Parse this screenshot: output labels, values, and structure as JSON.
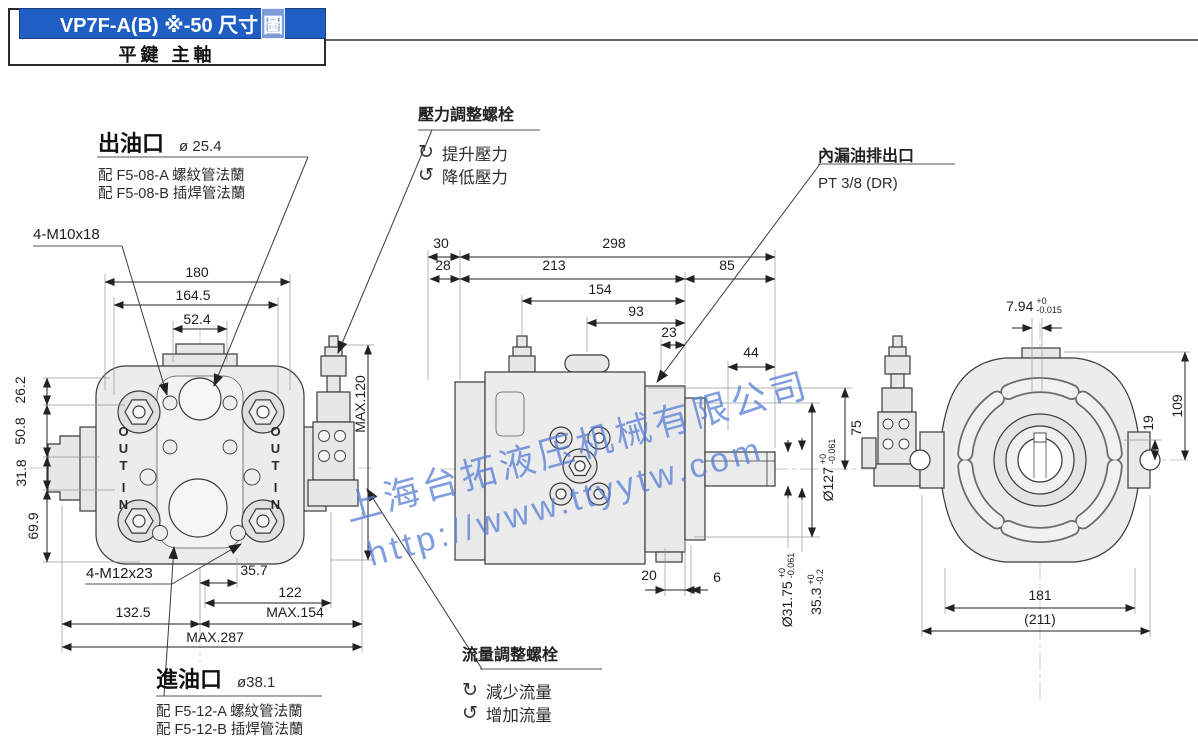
{
  "header": {
    "title_main": "VP7F-A(B) ※-50 尺寸",
    "title_tail": "圖",
    "subtitle": "平鍵 主軸"
  },
  "callouts": {
    "outlet": {
      "title": "出油口",
      "dia": "ø 25.4",
      "fit_a": "配 F5-08-A 螺紋管法蘭",
      "fit_b": "配 F5-08-B 插焊管法蘭"
    },
    "inlet": {
      "title": "進油口",
      "dia": "ø38.1",
      "fit_a": "配 F5-12-A 螺紋管法蘭",
      "fit_b": "配 F5-12-B 插焊管法蘭"
    },
    "pressure_screw": {
      "title": "壓力調整螺栓",
      "cw_icon": "↻",
      "cw_text": "提升壓力",
      "ccw_icon": "↺",
      "ccw_text": "降低壓力"
    },
    "flow_screw": {
      "title": "流量調整螺栓",
      "cw_icon": "↻",
      "cw_text": "減少流量",
      "ccw_icon": "↺",
      "ccw_text": "增加流量"
    },
    "drain": {
      "title": "內漏油排出口",
      "port": "PT 3/8 (DR)"
    },
    "bolts_top": "4-M10x18",
    "bolts_bottom": "4-M12x23"
  },
  "front_view": {
    "ports": {
      "out": "OUT",
      "in": "IN"
    },
    "dims": {
      "w_outer": "180",
      "w_bolt": "164.5",
      "w_flange": "52.4",
      "h_a": "26.2",
      "h_b": "50.8",
      "h_c": "31.8",
      "h_d": "69.9",
      "b_a": "35.7",
      "b_b": "122",
      "b_c": "MAX.154",
      "b_d": "132.5",
      "b_e": "MAX.287",
      "height_max": "MAX.120"
    }
  },
  "side_view": {
    "dims": {
      "t_a": "30",
      "t_b": "298",
      "t_c": "28",
      "t_d": "213",
      "t_e": "85",
      "t_f": "154",
      "t_g": "93",
      "t_h": "23",
      "t_i": "44",
      "r_a": "75",
      "pilot": {
        "v": "Ø127",
        "up": "+0",
        "dn": "-0.061"
      },
      "b_a": "20",
      "b_b": "6",
      "shaft": {
        "v": "Ø31.75",
        "up": "+0",
        "dn": "-0.061"
      },
      "key_h": {
        "v": "35.3",
        "up": "+0",
        "dn": "-0.2"
      }
    }
  },
  "rear_view": {
    "dims": {
      "key_w": {
        "v": "7.94",
        "up": "+0",
        "dn": "-0.015"
      },
      "r_a": "19",
      "r_b": "109",
      "b_a": "181",
      "b_b": "(211)"
    }
  },
  "watermark": {
    "line1": "上海台拓液压机械有限公司",
    "line2": "http://www.ttyytw.com"
  },
  "colors": {
    "title_bar_bg": "#1f5fc4",
    "watermark_blue": "#567cd6",
    "line_dark": "#3a3a3a",
    "body_fill": "#ececec"
  }
}
